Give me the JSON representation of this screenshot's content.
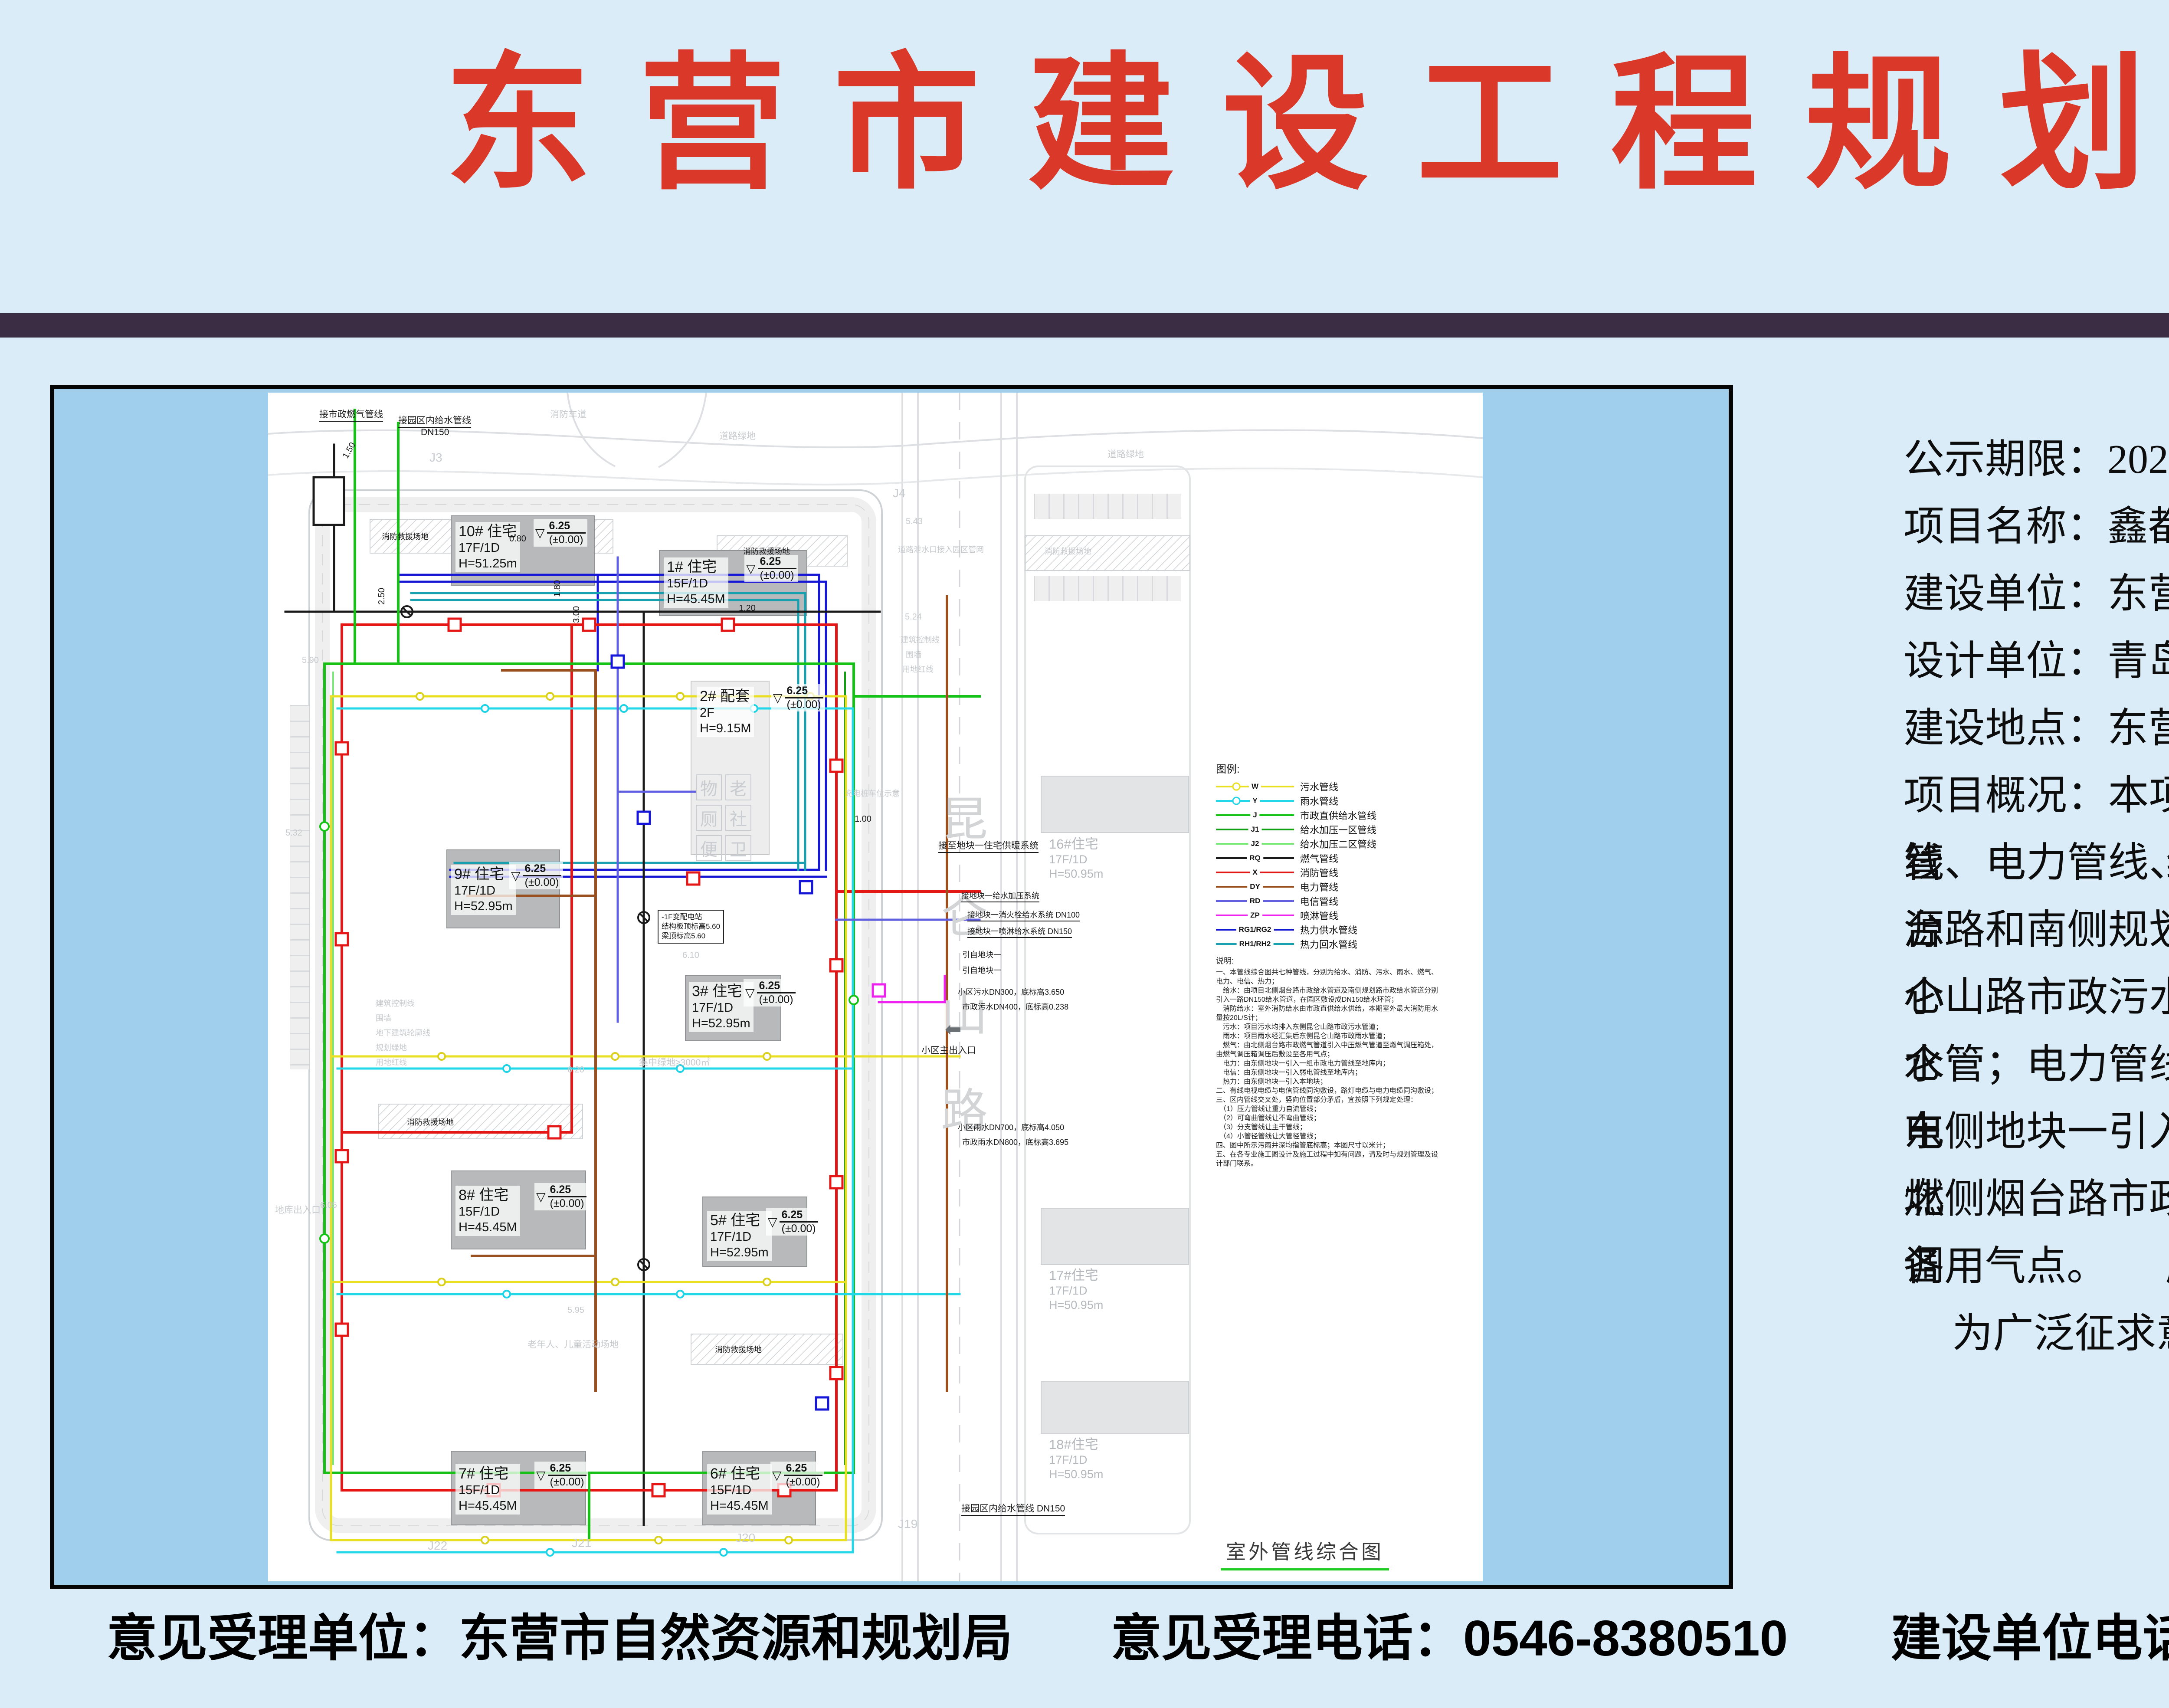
{
  "page": {
    "title": "东营市建设工程规划方案公示",
    "colors": {
      "background": "#d9ecf7",
      "title_red": "#da392a",
      "divider": "#3b2e44",
      "map_margin_blue": "#9fcfec",
      "sheet_white": "#ffffff",
      "legend_underline_green": "#1ecb1e"
    }
  },
  "info": {
    "lines": [
      "公示期限：2025 年 8 月 26 日至 2025 年 9 月 3 日共计 7 个工作日",
      "项目名称：鑫都 · 国子甲第地块二室外配套工程",
      "建设单位：东营鑫旭置业有限公司",
      "设计单位：青岛腾远设计事务所有限公司",
      "建设地点：东营市东营区胜利街道，庐山路以东、烟台路以南。",
      "项目概况：本项目室外配套包括生活给水管线、消防管线、污水管线、雨水管线、燃气管",
      "线、电力管线、电信管线、热力管线等。本项目生活给水管线、消防管线水源引自北侧烟",
      "台路和南侧规划路市政给水管网；污水管线：由新建污水管道汇流后，排入小区外东侧昆",
      "仑山路市政污水管；雨水管线：由新建雨水管道汇流后，排入小区外东侧昆仑山路市政雨",
      "水管；电力管线：由东侧地块一引入一组市政电力管线至地下车库配电室；电信管线：由",
      "东侧地块一引入弱电管线至地库内；热力管线：由东侧地块一引入本地块；燃气管由：由",
      "北侧烟台路市政燃气管道引入中压燃气管道至燃气调压箱处，由燃气调压箱调压后敷设至",
      "各用气点。",
      "为广泛征求意见，现对该项目进行规划方案公示。"
    ]
  },
  "footer": {
    "items": [
      {
        "text": "意见受理单位：东营市自然资源和规划局"
      },
      {
        "text": "意见受理电话：0546-8380510"
      },
      {
        "text": "建设单位电话：0546-6718888"
      }
    ]
  },
  "plan": {
    "title": "室外管线综合图",
    "road_name": "昆仑山路",
    "legend": {
      "heading": "图例:",
      "items": [
        {
          "code": "W",
          "label": "污水管线",
          "color": "#e8e020"
        },
        {
          "code": "Y",
          "label": "雨水管线",
          "color": "#22d8e8"
        },
        {
          "code": "J",
          "label": "市政直供给水管线",
          "color": "#16c216"
        },
        {
          "code": "J1",
          "label": "给水加压一区管线",
          "color": "#12a012"
        },
        {
          "code": "J2",
          "label": "给水加压二区管线",
          "color": "#7ce87c"
        },
        {
          "code": "RQ",
          "label": "燃气管线",
          "color": "#1a1a1a"
        },
        {
          "code": "X",
          "label": "消防管线",
          "color": "#e41616"
        },
        {
          "code": "DY",
          "label": "电力管线",
          "color": "#9a4f1e"
        },
        {
          "code": "RD",
          "label": "电信管线",
          "color": "#5f5fe0"
        },
        {
          "code": "ZP",
          "label": "喷淋管线",
          "color": "#ee22ee"
        },
        {
          "code": "RG1/RG2",
          "label": "热力供水管线",
          "color": "#1616d8"
        },
        {
          "code": "RH1/RH2",
          "label": "热力回水管线",
          "color": "#18a0b0"
        }
      ]
    },
    "notes": {
      "heading": "说明:",
      "text": "一、本管线综合图共七种管线，分别为给水、消防、污水、雨水、燃气、电力、电信、热力；\n　给水：由项目北侧烟台路市政给水管道及南侧规划路市政给水管道分别引入一路DN150给水管道，在园区敷设成DN150给水环管；\n　消防给水：室外消防给水由市政直供给水供给，本期室外最大消防用水量按20L/S计；\n　污水：项目污水均排入东侧昆仑山路市政污水管道；\n　雨水：项目雨水经汇集后东侧昆仑山路市政雨水管道；\n　燃气：由北侧烟台路市政燃气管道引入中压燃气管道至燃气调压箱处，由燃气调压箱调压后敷设至各用气点；\n　电力：由东侧地块一引入一组市政电力管线至地库内；\n　电信：由东侧地块一引入弱电管线至地库内；\n　热力：由东侧地块一引入本地块；\n二、有线电视电缆与电信管线同沟敷设，路灯电缆与电力电缆同沟敷设；\n三、区内管线交叉处，竖向位置部分矛盾，宜按照下列规定处理：\n　（1）压力管线让重力自流管线；\n　（2）可弯曲管线让不弯曲管线；\n　（3）分支管线让主干管线；\n　（4）小管径管线让大管径管线；\n四、图中所示污雨井深均指管底标高；本图尺寸以米计；\n五、在各专业施工图设计及施工过程中如有问题，请及时与规划管理及设计部门联系。"
    },
    "buildings": [
      {
        "name": "10# 住宅",
        "floors": "17F/1D",
        "height": "H=51.25m",
        "elev": "6.25",
        "datum": "(±0.00)"
      },
      {
        "name": "1# 住宅",
        "floors": "15F/1D",
        "height": "H=45.45M",
        "elev": "6.25",
        "datum": "(±0.00)"
      },
      {
        "name": "2# 配套",
        "floors": "2F",
        "height": "H=9.15M",
        "elev": "6.25",
        "datum": "(±0.00)"
      },
      {
        "name": "9# 住宅",
        "floors": "17F/1D",
        "height": "H=52.95m",
        "elev": "6.25",
        "datum": "(±0.00)"
      },
      {
        "name": "3# 住宅",
        "floors": "17F/1D",
        "height": "H=52.95m",
        "elev": "6.25",
        "datum": "(±0.00)"
      },
      {
        "name": "8# 住宅",
        "floors": "15F/1D",
        "height": "H=45.45M",
        "elev": "6.25",
        "datum": "(±0.00)"
      },
      {
        "name": "5# 住宅",
        "floors": "17F/1D",
        "height": "H=52.95m",
        "elev": "6.25",
        "datum": "(±0.00)"
      },
      {
        "name": "7# 住宅",
        "floors": "15F/1D",
        "height": "H=45.45M",
        "elev": "6.25",
        "datum": "(±0.00)"
      },
      {
        "name": "6# 住宅",
        "floors": "15F/1D",
        "height": "H=45.45M",
        "elev": "6.25",
        "datum": "(±0.00)"
      }
    ],
    "adjacent": [
      {
        "name": "16#住宅",
        "floors": "17F/1D",
        "height": "H=50.95m"
      },
      {
        "name": "17#住宅",
        "floors": "17F/1D",
        "height": "H=50.95m"
      },
      {
        "name": "18#住宅",
        "floors": "17F/1D",
        "height": "H=50.95m"
      }
    ],
    "service_grid": [
      "物",
      "老",
      "厕",
      "社",
      "便",
      "卫"
    ],
    "ann": {
      "gas_tap": "接市政燃气管线",
      "park_water": "接园区内给水管线",
      "dn150": "DN150",
      "fire_lane": "消防车道",
      "road_green": "道路绿地",
      "fire_rescue": "消防救援场地",
      "main_entrance": "小区主出入口",
      "central_green": "集中绿地≥3000㎡",
      "elder_play": "老年人、儿童活动场地",
      "garage_entry": "地库出入口",
      "heat_connect": "接至地块一住宅供暖系统",
      "boost_connect": "接地块一给水加压系统",
      "hydrant_connect": "接地块一消火栓给水系统 DN100",
      "spray_connect": "接地块一喷淋给水系统 DN150",
      "from_block1": "引自地块一",
      "park_water_dn": "接园区内给水管线 DN150",
      "bldg_ctrl": "建筑控制线",
      "wall": "围墙",
      "underground": "地下建筑轮廓线",
      "plan_green": "规划绿地",
      "red_line": "用地红线",
      "drain_note": "道路泄水口接入园区管网",
      "power_station": "-1F变配电站\n结构板顶标高5.60\n梁顶标高5.60",
      "charge_note": "充电桩车位示意",
      "sewage1": "小区污水DN300，底标高3.650",
      "sewage2": "市政污水DN400，底标高0.238",
      "rain1": "小区雨水DN700，底标高4.050",
      "rain2": "市政雨水DN800，底标高3.695"
    },
    "markers": {
      "j3": "J3",
      "j4": "J4",
      "j19": "J19",
      "j20": "J20",
      "j21": "J21",
      "j22": "J22"
    },
    "levels": [
      "5.90",
      "5.32",
      "6.20",
      "6.10",
      "6.05",
      "5.95",
      "5.24",
      "5.43",
      "1.00"
    ],
    "dims": [
      "1.50",
      "0.80",
      "2.50",
      "1.80",
      "3.00",
      "1.20"
    ],
    "icons": {
      "datum_triangle": "▽",
      "entrance_arrow": "⬅"
    }
  }
}
